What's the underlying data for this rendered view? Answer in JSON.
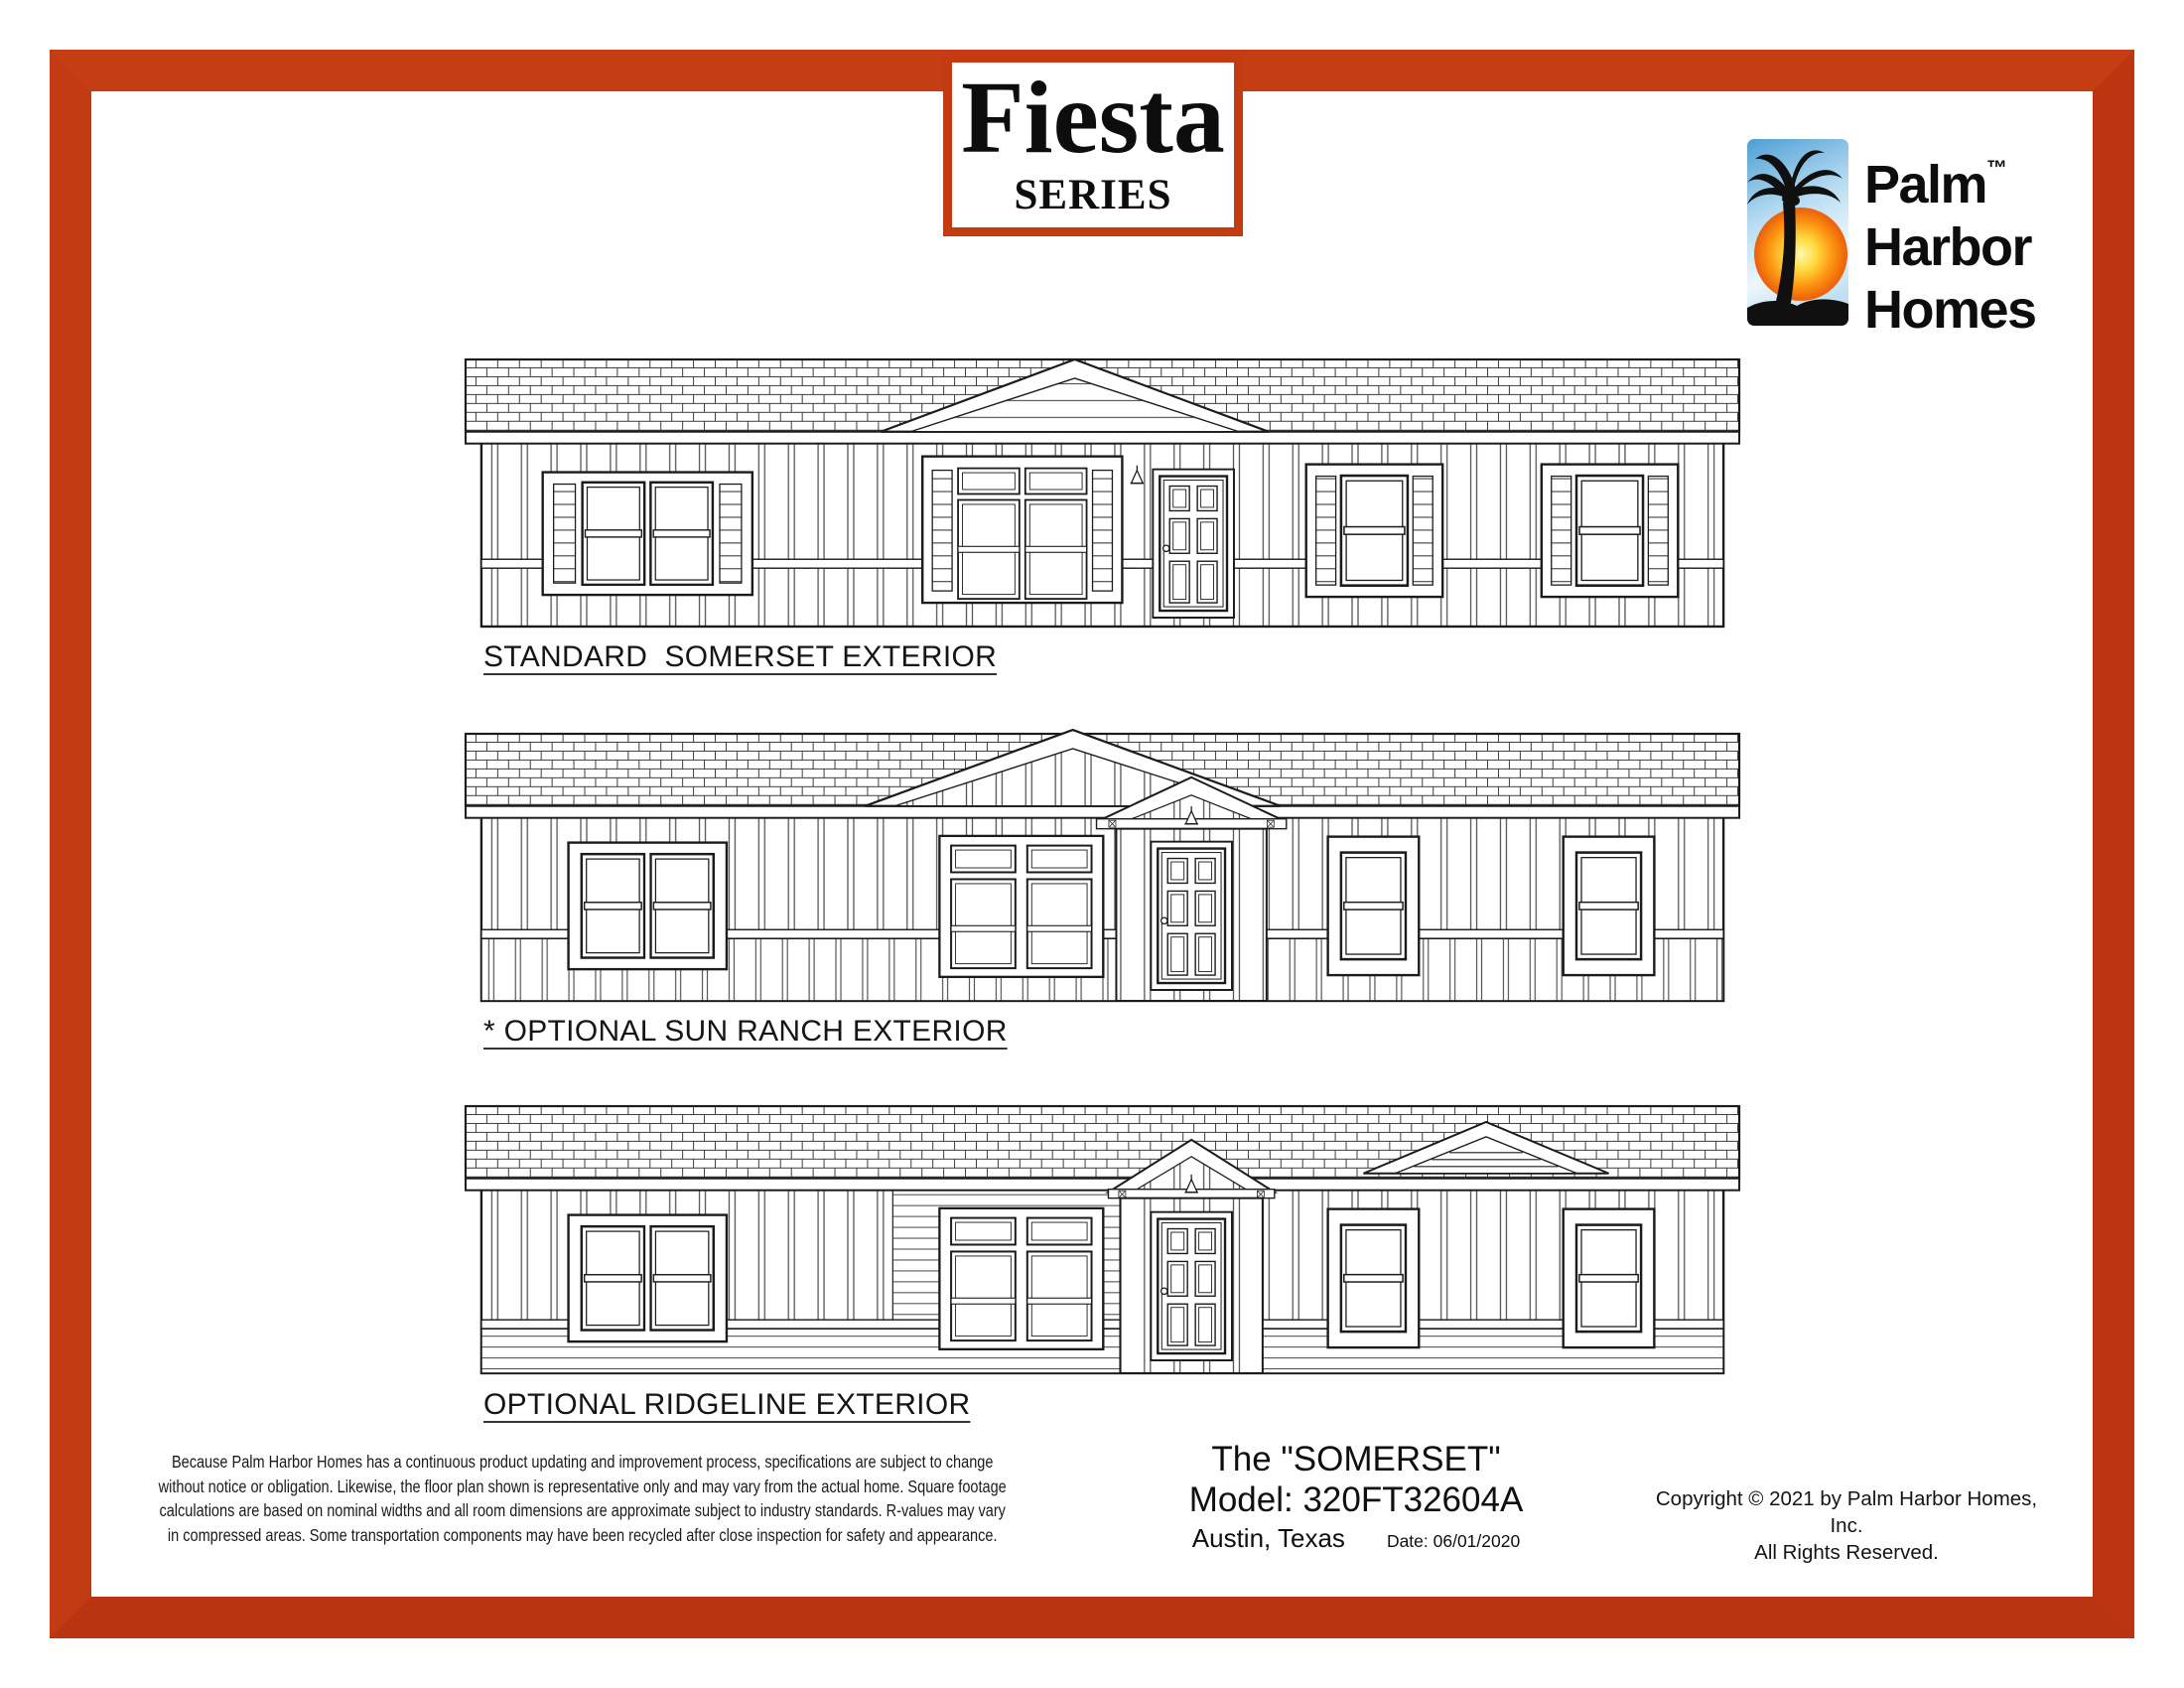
{
  "frame": {
    "color": "#c13a10"
  },
  "series_badge": {
    "name": "Fiesta",
    "subtitle": "SERIES",
    "border_color": "#c33b10"
  },
  "brand": {
    "word1": "Palm",
    "trademark": "™",
    "word2": "Harbor",
    "word3": "Homes",
    "icon": "palm-tree-sunset-icon",
    "colors": {
      "sky": "#4d9fd4",
      "sun_inner": "#fff9ae",
      "sun_outer": "#ea5f0b",
      "silhouette": "#101010"
    }
  },
  "elevations": [
    {
      "label": "STANDARD  SOMERSET EXTERIOR"
    },
    {
      "label": "* OPTIONAL SUN RANCH EXTERIOR"
    },
    {
      "label": "OPTIONAL RIDGELINE EXTERIOR"
    }
  ],
  "disclaimer": {
    "line1": "Because Palm Harbor Homes has a continuous product updating and improvement process, specifications are subject to change",
    "line2": "without notice or obligation. Likewise, the floor plan shown is representative only and may vary from the actual home. Square footage",
    "line3": "calculations are based on nominal widths and all room dimensions are approximate subject to industry standards. R-values may vary",
    "line4": "in compressed areas. Some transportation components may have been recycled after close inspection for safety and appearance."
  },
  "model_info": {
    "title": "The \"SOMERSET\"",
    "model_line": "Model: 320FT32604A",
    "location": "Austin, Texas",
    "date": "Date: 06/01/2020"
  },
  "copyright": {
    "line1": "Copyright © 2021 by Palm Harbor Homes, Inc.",
    "line2": "All Rights Reserved."
  }
}
